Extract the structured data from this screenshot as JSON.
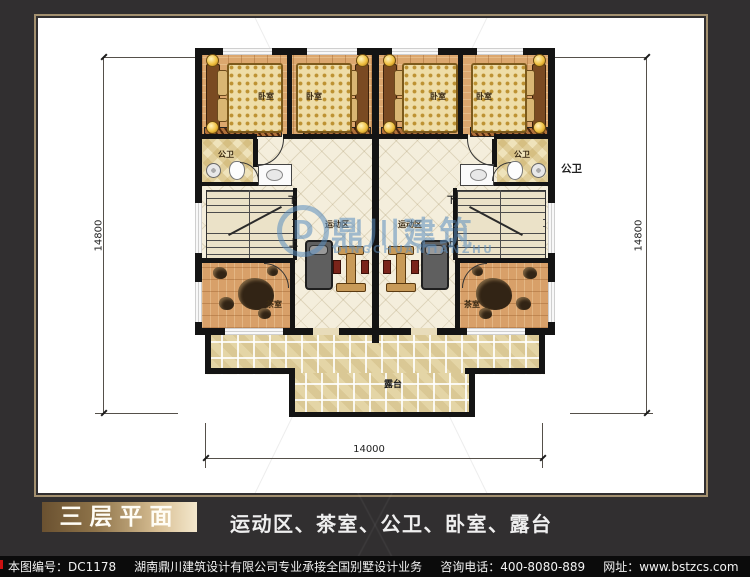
{
  "colors": {
    "background": "#312f30",
    "paper": "#ffffff",
    "frame_line": "#a3906f",
    "badge_gold_dark": "#6a5130",
    "badge_gold_light": "#f4e8cd",
    "watermark_blue": "#5b8fc0",
    "wall": "#141414",
    "wood_floor": "#dca76e",
    "tile_floor": "#f4eedc",
    "terrace_tile": "#e4d5a6",
    "footer_bg": "#0b0b0b"
  },
  "plan": {
    "labels": {
      "bedroom": "卧室",
      "bathroom": "公卫",
      "gym": "运动区",
      "tea_room": "茶室",
      "terrace": "露台",
      "stair_down": "下",
      "stair_up": "上"
    },
    "dimensions": {
      "left": "14800",
      "right": "14800",
      "bottom": "14000"
    }
  },
  "watermark": {
    "logo_letter": "D",
    "name_cn": "鼎川建筑",
    "name_en": "DINGCHUANJIANZHU"
  },
  "caption": {
    "title": "三层平面",
    "subtitle": "运动区、茶室、公卫、卧室、露台"
  },
  "footer": {
    "drawing_no": "本图编号：DC1178",
    "company": "湖南鼎川建筑设计有限公司专业承接全国别墅设计业务",
    "phone": "咨询电话：400-8080-889",
    "website": "网址：www.bstzcs.com"
  }
}
